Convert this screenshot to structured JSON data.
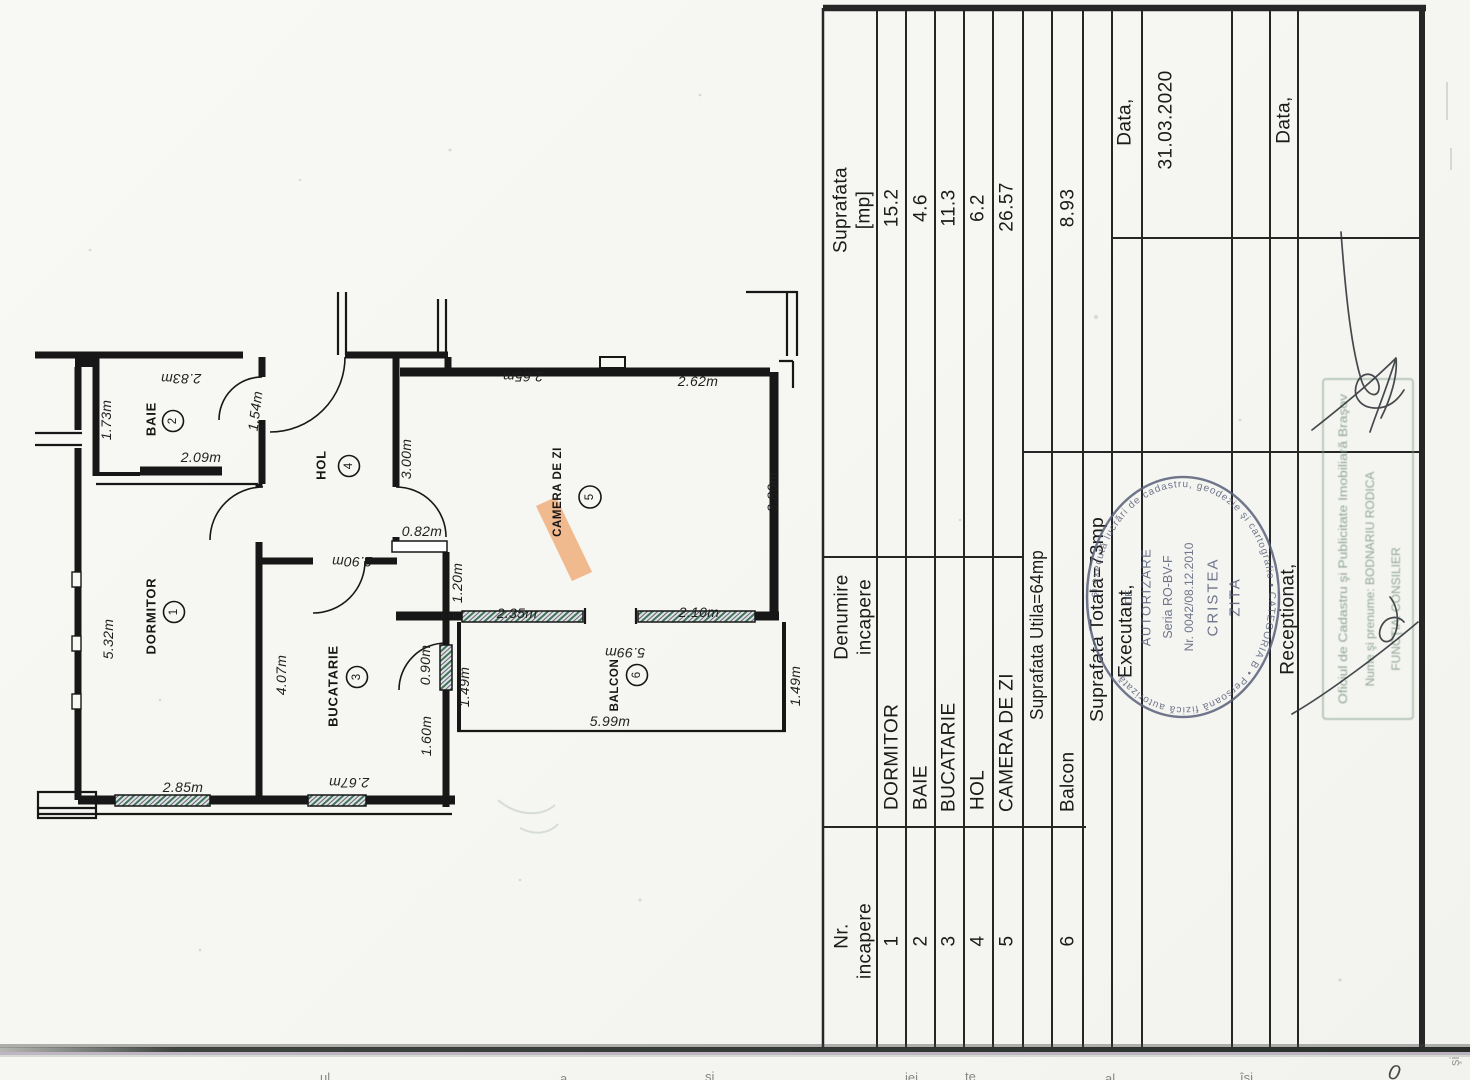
{
  "plan": {
    "rooms": [
      {
        "number": "1",
        "name": "DORMITOR"
      },
      {
        "number": "2",
        "name": "BAIE"
      },
      {
        "number": "3",
        "name": "BUCATARIE"
      },
      {
        "number": "4",
        "name": "HOL"
      },
      {
        "number": "5",
        "name": "CAMERA DE ZI"
      },
      {
        "number": "6",
        "name": "BALCON"
      }
    ],
    "dims": {
      "baie_width": "2.83m",
      "baie_height": "1.73m",
      "baie_inner": "2.09m",
      "baie_entry": "1.54m",
      "hol_height": "3.00m",
      "hol_sill": "0.82m",
      "hol_width": "2.90m",
      "hol_passage": "1.20m",
      "dormitor_height": "5.32m",
      "dormitor_width": "2.85m",
      "dormitor_right": "4.07m",
      "bucatarie_door": "0.90m",
      "bucatarie_right": "1.60m",
      "bucatarie_width": "2.67m",
      "strip_left": "1.49m",
      "camera_top_left": "2.65m",
      "camera_top_right": "2.62m",
      "camera_right": "3.80m",
      "camera_bottom_left": "2.35m",
      "camera_bottom_right": "2.10m",
      "balcon_top": "5.99m",
      "balcon_bottom": "5.99m",
      "balcon_right": "1.49m"
    }
  },
  "table": {
    "headers": {
      "area1": "Suprafata",
      "area2": "[mp]",
      "name1": "Denumire",
      "name2": "incapere",
      "nr1": "Nr.",
      "nr2": "incapere"
    },
    "rows": [
      {
        "nr": "1",
        "name": "DORMITOR",
        "area": "15.2"
      },
      {
        "nr": "2",
        "name": "BAIE",
        "area": "4.6"
      },
      {
        "nr": "3",
        "name": "BUCATARIE",
        "area": "11.3"
      },
      {
        "nr": "4",
        "name": "HOL",
        "area": "6.2"
      },
      {
        "nr": "5",
        "name": "CAMERA DE ZI",
        "area": "26.57"
      },
      {
        "nr": "6",
        "name": "Balcon",
        "area": "8.93"
      }
    ],
    "summary": {
      "utila": "Suprafata Utila=64mp",
      "totala": "Suprafata Totala=73mp"
    },
    "labels": {
      "executant": "Executant,",
      "data1": "Data,",
      "date": "31.03.2020",
      "receptionat": "Receptionat,",
      "data2": "Data,"
    }
  },
  "round_stamp": {
    "rim": "şi execută lucrări de cadastru, geodezie şi cartografie • CATEGORIA B • Persoană fizică autorizată",
    "line1": "DE",
    "line2": "AUTORIZARE",
    "line3": "Seria RO-BV-F",
    "line4": "Nr. 0042/08.12.2010",
    "line5": "CRISTEA",
    "line6": "ZITA"
  },
  "office_stamp": {
    "line1": "Oficiul de Cadastru şi Publicitate Imobiliară Braşov",
    "line2": "Nume şi prenume: BODNARIU RODICA",
    "line3": "FUNCŢIA: CONSILIER"
  },
  "edge": {
    "fragments": [
      "ul",
      "a",
      "şi",
      "iei",
      "te",
      "al",
      "îşi"
    ],
    "handwritten": "0",
    "side_fragment": "şi"
  }
}
